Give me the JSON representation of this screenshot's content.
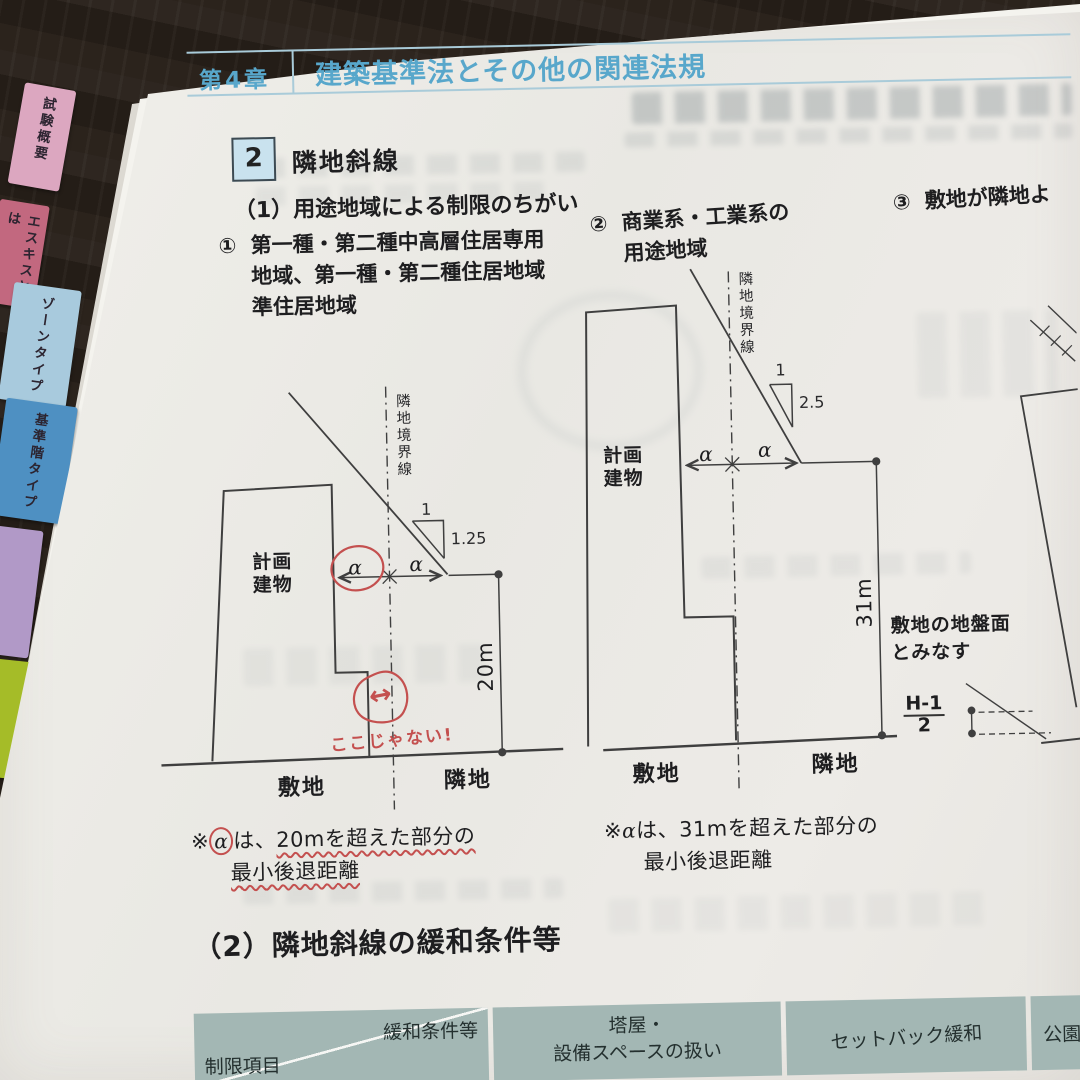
{
  "chapter": {
    "label": "第4章",
    "title": "建築基準法とその他の関連法規"
  },
  "section": {
    "number": "2",
    "title": "隣地斜線"
  },
  "subsections": {
    "s1": "（1）用途地域による制限のちがい",
    "s2": "（2）隣地斜線の緩和条件等"
  },
  "items": {
    "item1": {
      "marker": "①",
      "line1": "第一種・第二種中高層住居専用",
      "line2": "地域、第一種・第二種住居地域",
      "line3": "準住居地域"
    },
    "item2": {
      "marker": "②",
      "line1": "商業系・工業系の",
      "line2": "用途地域"
    },
    "item3": {
      "marker": "③",
      "text": "敷地が隣地よ"
    }
  },
  "tabs": [
    {
      "label": "試験概要",
      "color": "#dca7c0"
    },
    {
      "label": "エスキスとは",
      "color": "#c2687f"
    },
    {
      "label": "ゾーンタイプ",
      "color": "#a8cadd"
    },
    {
      "label": "基準階タイプ",
      "color": "#4e90c2"
    },
    {
      "label": "",
      "color": "#b199c7"
    },
    {
      "label": "",
      "color": "#a5bc28"
    }
  ],
  "diagram1": {
    "boundary_label": "隣地境界線",
    "building_line1": "計画",
    "building_line2": "建物",
    "slope_run": "1",
    "slope_rise": "1.25",
    "alpha_left": "α",
    "alpha_right": "α",
    "height_label": "20m",
    "site_label": "敷地",
    "neighbor_label": "隣地",
    "note_prefix": "※",
    "note_alpha": "α",
    "note_mid": "は、",
    "note_rest": "20mを超えた部分の",
    "note_line2": "最小後退距離",
    "annotation_arrow": "↔",
    "annotation_text": "ここじゃない!"
  },
  "diagram2": {
    "boundary_label": "隣地境界線",
    "building_line1": "計画",
    "building_line2": "建物",
    "slope_run": "1",
    "slope_rise": "2.5",
    "alpha_left": "α",
    "alpha_right": "α",
    "height_label": "31m",
    "site_label": "敷地",
    "neighbor_label": "隣地",
    "note_prefix": "※",
    "note_alpha": "α",
    "note_mid": "は、",
    "note_rest": "31mを超えた部分の",
    "note_line2": "最小後退距離"
  },
  "diagram3": {
    "ground_note_line1": "敷地の地盤面",
    "ground_note_line2": "とみなす",
    "fraction_numerator": "H-1",
    "fraction_denominator": "2"
  },
  "table": {
    "header": {
      "col1_top": "緩和条件等",
      "col1_bottom": "制限項目",
      "col2_line1": "塔屋・",
      "col2_line2": "設備スペースの扱い",
      "col3": "セットバック緩和",
      "col4": "公園等"
    }
  },
  "colors": {
    "header_accent": "#58a7cb",
    "section_box_bg": "#c9e2ee",
    "table_header_bg": "#a3b7b4",
    "annotation_red": "#c4504f"
  }
}
